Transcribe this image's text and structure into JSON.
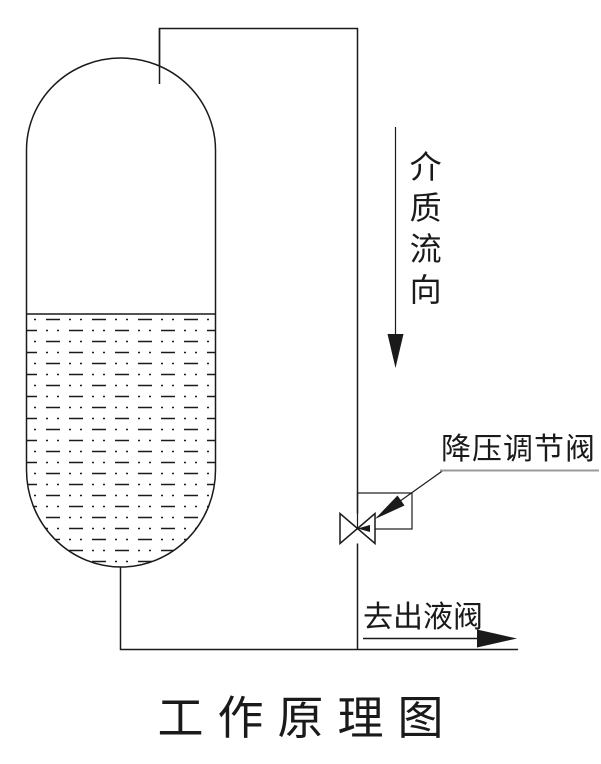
{
  "title": {
    "text": "工作原理图"
  },
  "diagram": {
    "flow_direction_label": "介质流向",
    "valve_label": "降压调节阀",
    "outlet_label": "去出液阀"
  },
  "colors": {
    "line": "#1a1a1a",
    "label_underline": "#9b9b9b",
    "background": "#ffffff"
  }
}
